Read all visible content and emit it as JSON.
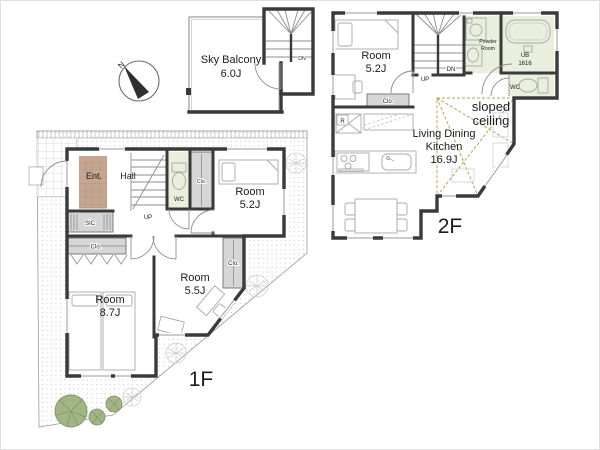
{
  "compass": {
    "north": "N"
  },
  "sky_balcony": {
    "name": "Sky Balcony",
    "area": "6.0J",
    "stairs_down": "DN"
  },
  "floor_2": {
    "floor_label": "2F",
    "bedroom": {
      "name": "Room",
      "area": "5.2J"
    },
    "closet": "Clo.",
    "stairs": {
      "up": "UP",
      "down": "DN"
    },
    "refrigerator": "R",
    "powder_room": {
      "line1": "Powder",
      "line2": "Room"
    },
    "unit_bath": {
      "line1": "UB",
      "line2": "1616"
    },
    "toilet": "WC",
    "sloped_ceiling": {
      "line1": "sloped",
      "line2": "ceiling"
    },
    "ldk": {
      "line1": "Living Dining",
      "line2": "Kitchen",
      "area": "16.9J"
    }
  },
  "floor_1": {
    "floor_label": "1F",
    "entrance": "Ent.",
    "hall": "Hall",
    "stairs_up": "UP",
    "toilet": "WC",
    "shoe_closet": "SIC",
    "hall_closet": "Clo.",
    "bedroom_closet": "Clo.",
    "room_closet": "Clo.",
    "bedroom_a": {
      "name": "Room",
      "area": "5.2J"
    },
    "bedroom_b": {
      "name": "Room",
      "area": "8.7J"
    },
    "bedroom_c": {
      "name": "Room",
      "area": "5.5J"
    }
  },
  "colors": {
    "wall": "#3a3a3a",
    "wet_room_green": "#e9efdc",
    "closet_gray": "#d6d6d6",
    "entrance_tile": "#c6a690",
    "sloped_ceiling_dash": "#b5a060",
    "garden_green": "#a3b486"
  }
}
